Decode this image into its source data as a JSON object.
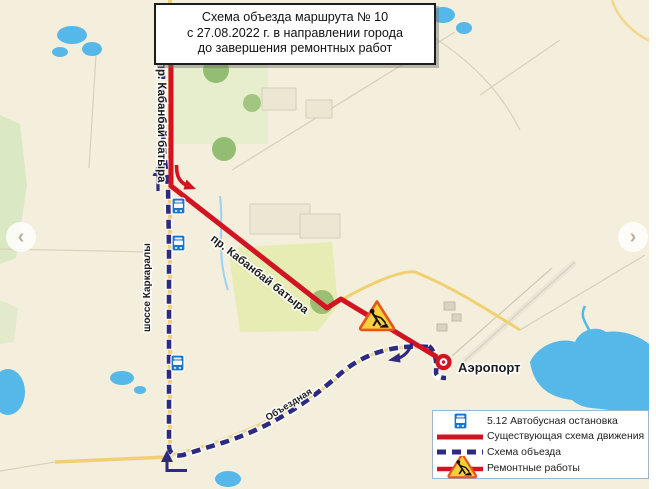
{
  "title_box": {
    "lines": [
      "Схема объезда маршрута № 10",
      "с 27.08.2022 г. в направлении города",
      "до завершения ремонтных работ"
    ]
  },
  "map": {
    "labels": {
      "road_vertical": "пр. Кабанбай батыра",
      "road_diagonal": "пр. Кабанбай батыра",
      "highway_vertical": "шоссе Каркаралы",
      "bypass_road": "Объездная",
      "airport": "Аэропорт"
    },
    "colors": {
      "existing_route": "#d11322",
      "detour_route": "#2e2a80",
      "bus_stop_sign": "#1a74c8",
      "roadworks_fill": "#ffce3e",
      "roadworks_border": "#e2581c",
      "map_background": "#f4eedc",
      "water": "#56b8e8",
      "main_road": "#f0d070"
    }
  },
  "legend": {
    "items": [
      {
        "icon": "bus-stop-sign",
        "label": "5.12 Автобусная остановка"
      },
      {
        "icon": "solid-red-line",
        "label": "Существующая схема движения"
      },
      {
        "icon": "dashed-blue-line",
        "label": "Схема объезда"
      },
      {
        "icon": "roadworks-sign",
        "label": "Ремонтные работы"
      }
    ]
  },
  "carousel": {
    "prev_icon": "‹",
    "next_icon": "›"
  }
}
